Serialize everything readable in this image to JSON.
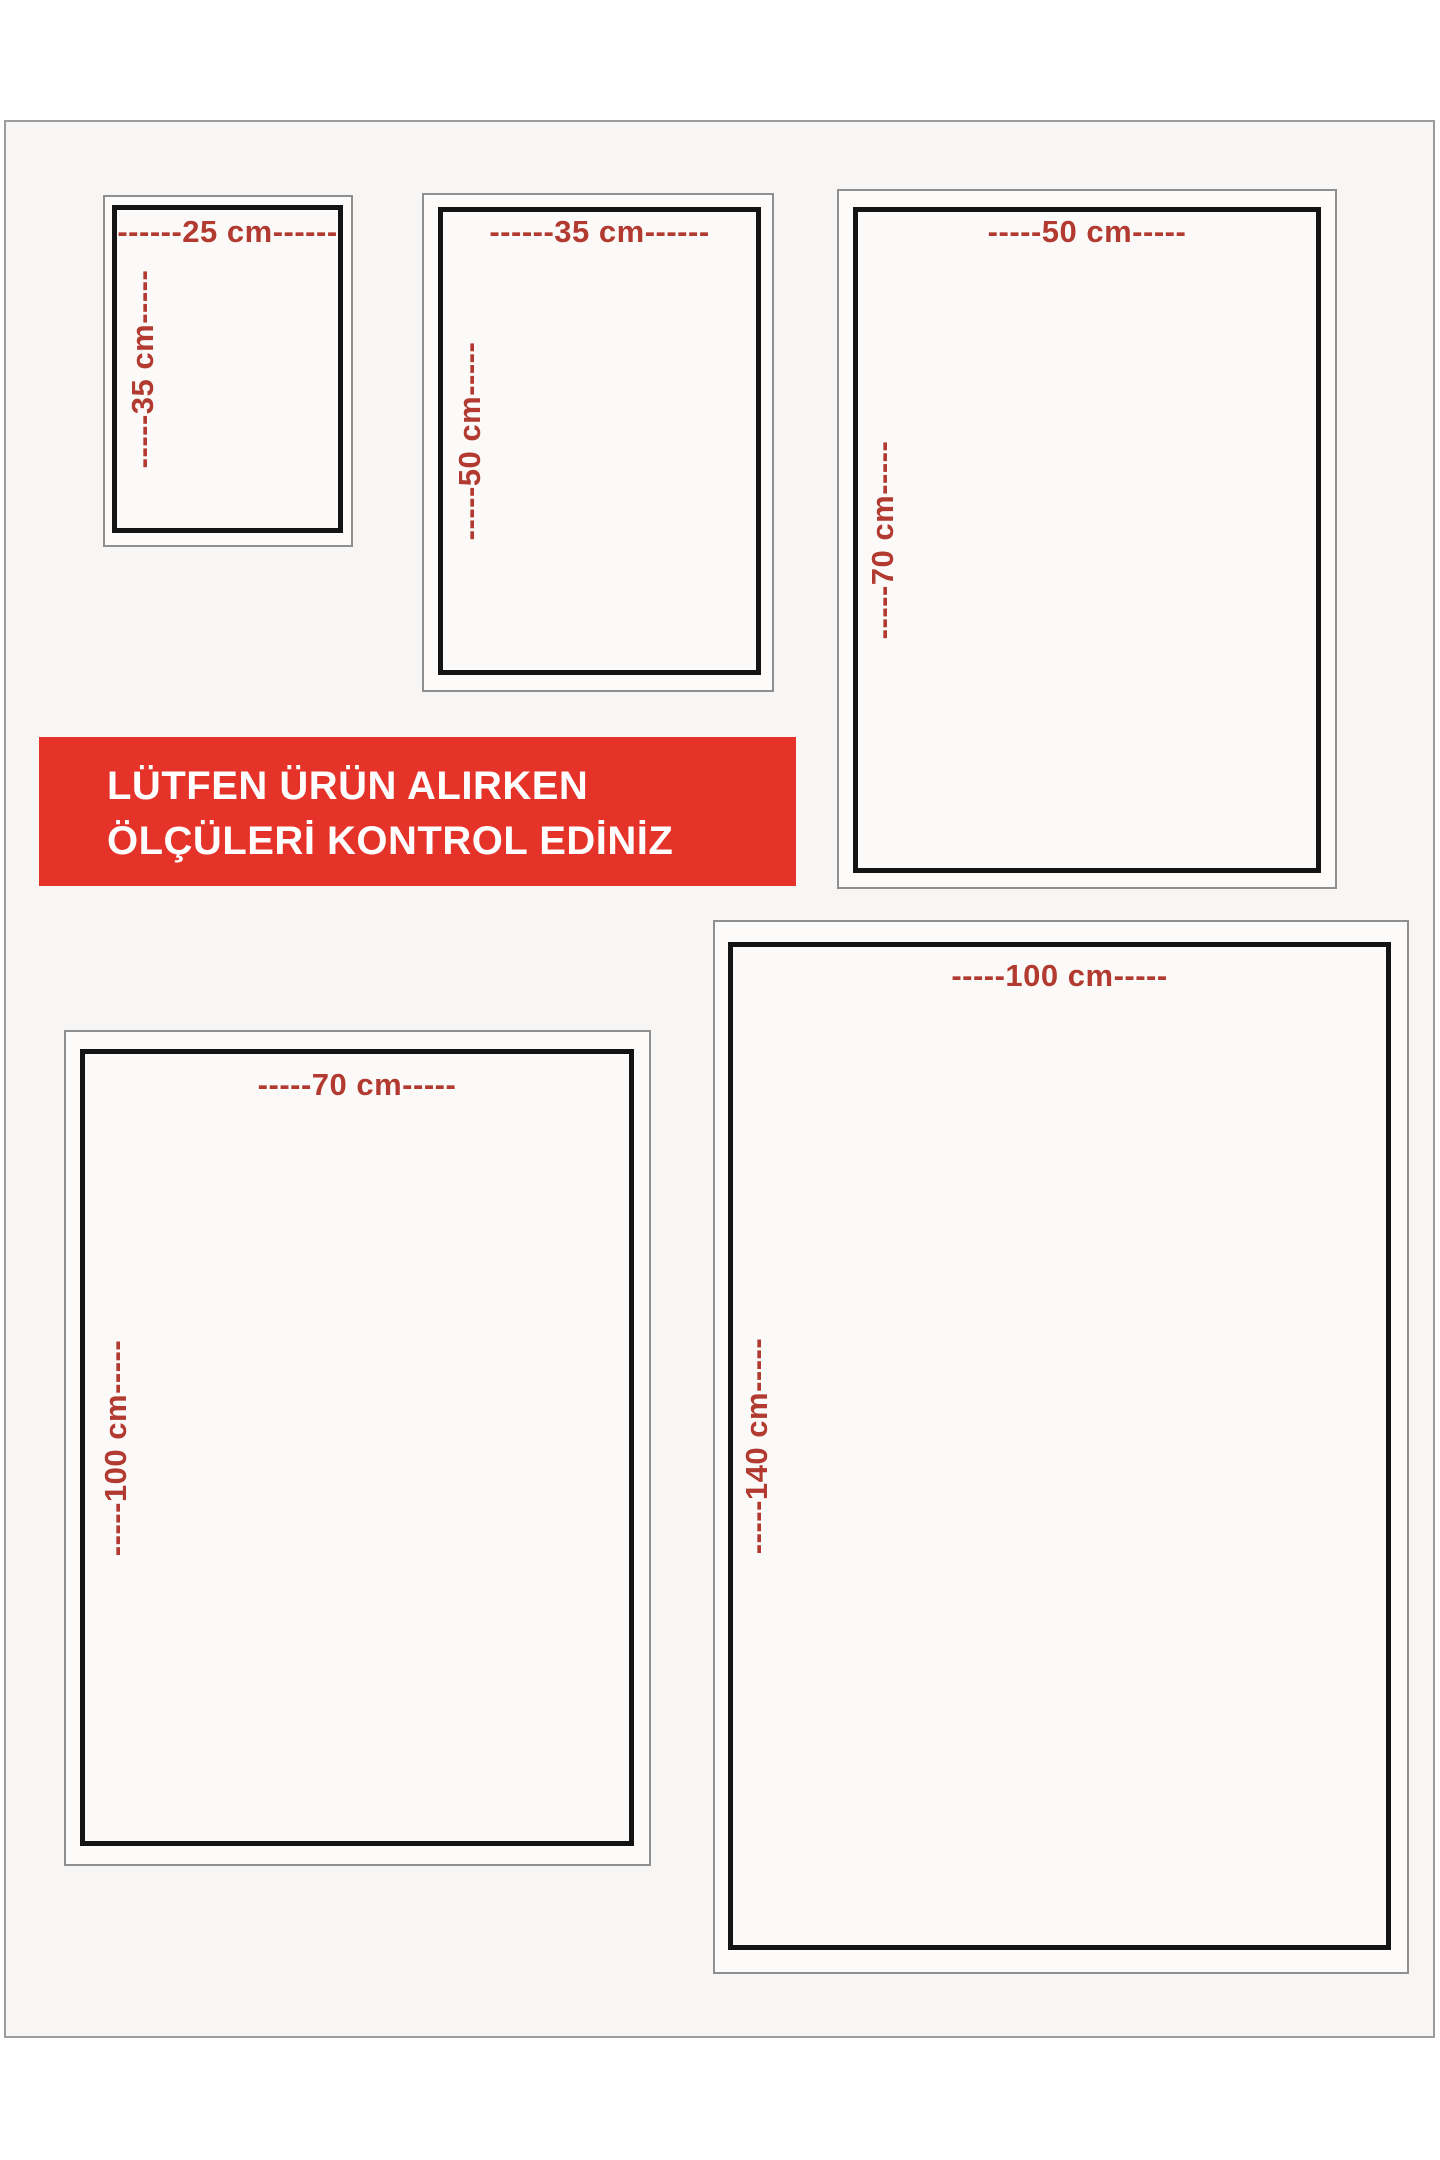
{
  "banner": {
    "bg_color": "#e53329",
    "text_color": "#ffffff",
    "line1": "LÜTFEN ÜRÜN ALIRKEN",
    "line2": "ÖLÇÜLERİ KONTROL EDİNİZ"
  },
  "label_color": "#b23a30",
  "sizes": [
    {
      "id": "25x35",
      "width_cm": 25,
      "height_cm": 35,
      "width_label": "------25 cm------",
      "height_label": "-----35 cm-----"
    },
    {
      "id": "35x50",
      "width_cm": 35,
      "height_cm": 50,
      "width_label": "------35 cm------",
      "height_label": "-----50 cm-----"
    },
    {
      "id": "50x70",
      "width_cm": 50,
      "height_cm": 70,
      "width_label": "-----50 cm-----",
      "height_label": "-----70 cm-----"
    },
    {
      "id": "70x100",
      "width_cm": 70,
      "height_cm": 100,
      "width_label": "-----70 cm-----",
      "height_label": "-----100 cm-----"
    },
    {
      "id": "100x140",
      "width_cm": 100,
      "height_cm": 140,
      "width_label": "-----100 cm-----",
      "height_label": "-----140 cm-----"
    }
  ]
}
